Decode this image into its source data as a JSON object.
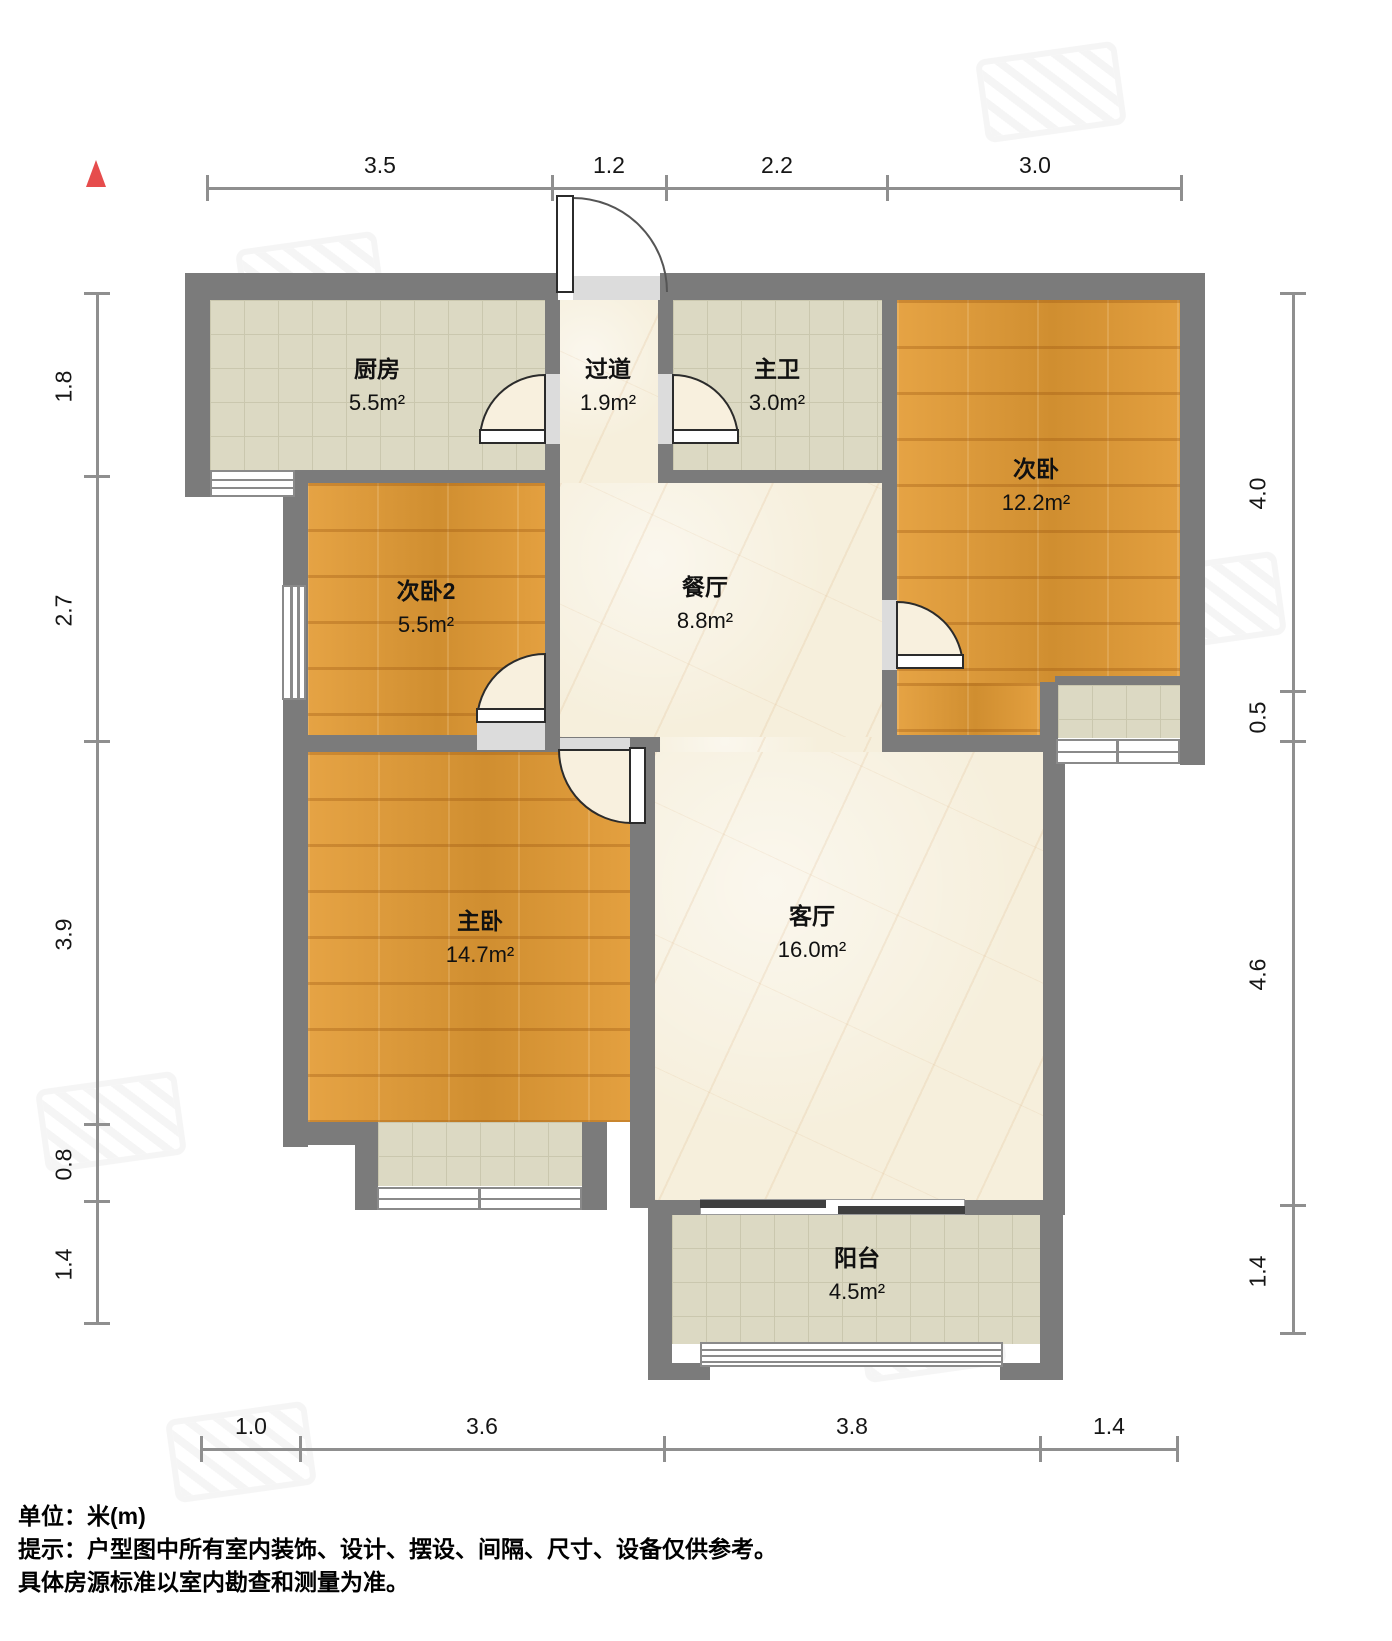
{
  "plan": {
    "type": "apartment-floorplan",
    "north_arrow": "up",
    "rooms": {
      "kitchen": {
        "name": "厨房",
        "area": "5.5m²"
      },
      "hallway": {
        "name": "过道",
        "area": "1.9m²"
      },
      "master_bath": {
        "name": "主卫",
        "area": "3.0m²"
      },
      "bedroom2": {
        "name": "次卧",
        "area": "12.2m²"
      },
      "bedroom3": {
        "name": "次卧2",
        "area": "5.5m²"
      },
      "dining": {
        "name": "餐厅",
        "area": "8.8m²"
      },
      "master_bedroom": {
        "name": "主卧",
        "area": "14.7m²"
      },
      "living": {
        "name": "客厅",
        "area": "16.0m²"
      },
      "balcony": {
        "name": "阳台",
        "area": "4.5m²"
      }
    },
    "dimensions_m": {
      "top": [
        "3.5",
        "1.2",
        "2.2",
        "3.0"
      ],
      "bottom": [
        "1.0",
        "3.6",
        "3.8",
        "1.4"
      ],
      "left": [
        "1.8",
        "2.7",
        "3.9",
        "0.8",
        "1.4"
      ],
      "right": [
        "4.0",
        "0.5",
        "4.6",
        "1.4"
      ]
    },
    "colors": {
      "wall": "#7b7b7b",
      "wood_floor": "#dd9733",
      "tile_floor": "#dcd9c3",
      "marble_floor": "#f6efdc",
      "threshold": "#dcdcdc",
      "dimension_line": "#8f8f8f",
      "north_arrow": "#e64c4c",
      "sliding_panel": "#3f3f3f"
    }
  },
  "footer": {
    "unit_line": "单位：米(m)",
    "tip_line1": "提示：户型图中所有室内装饰、设计、摆设、间隔、尺寸、设备仅供参考。",
    "tip_line2": "具体房源标准以室内勘查和测量为准。"
  }
}
